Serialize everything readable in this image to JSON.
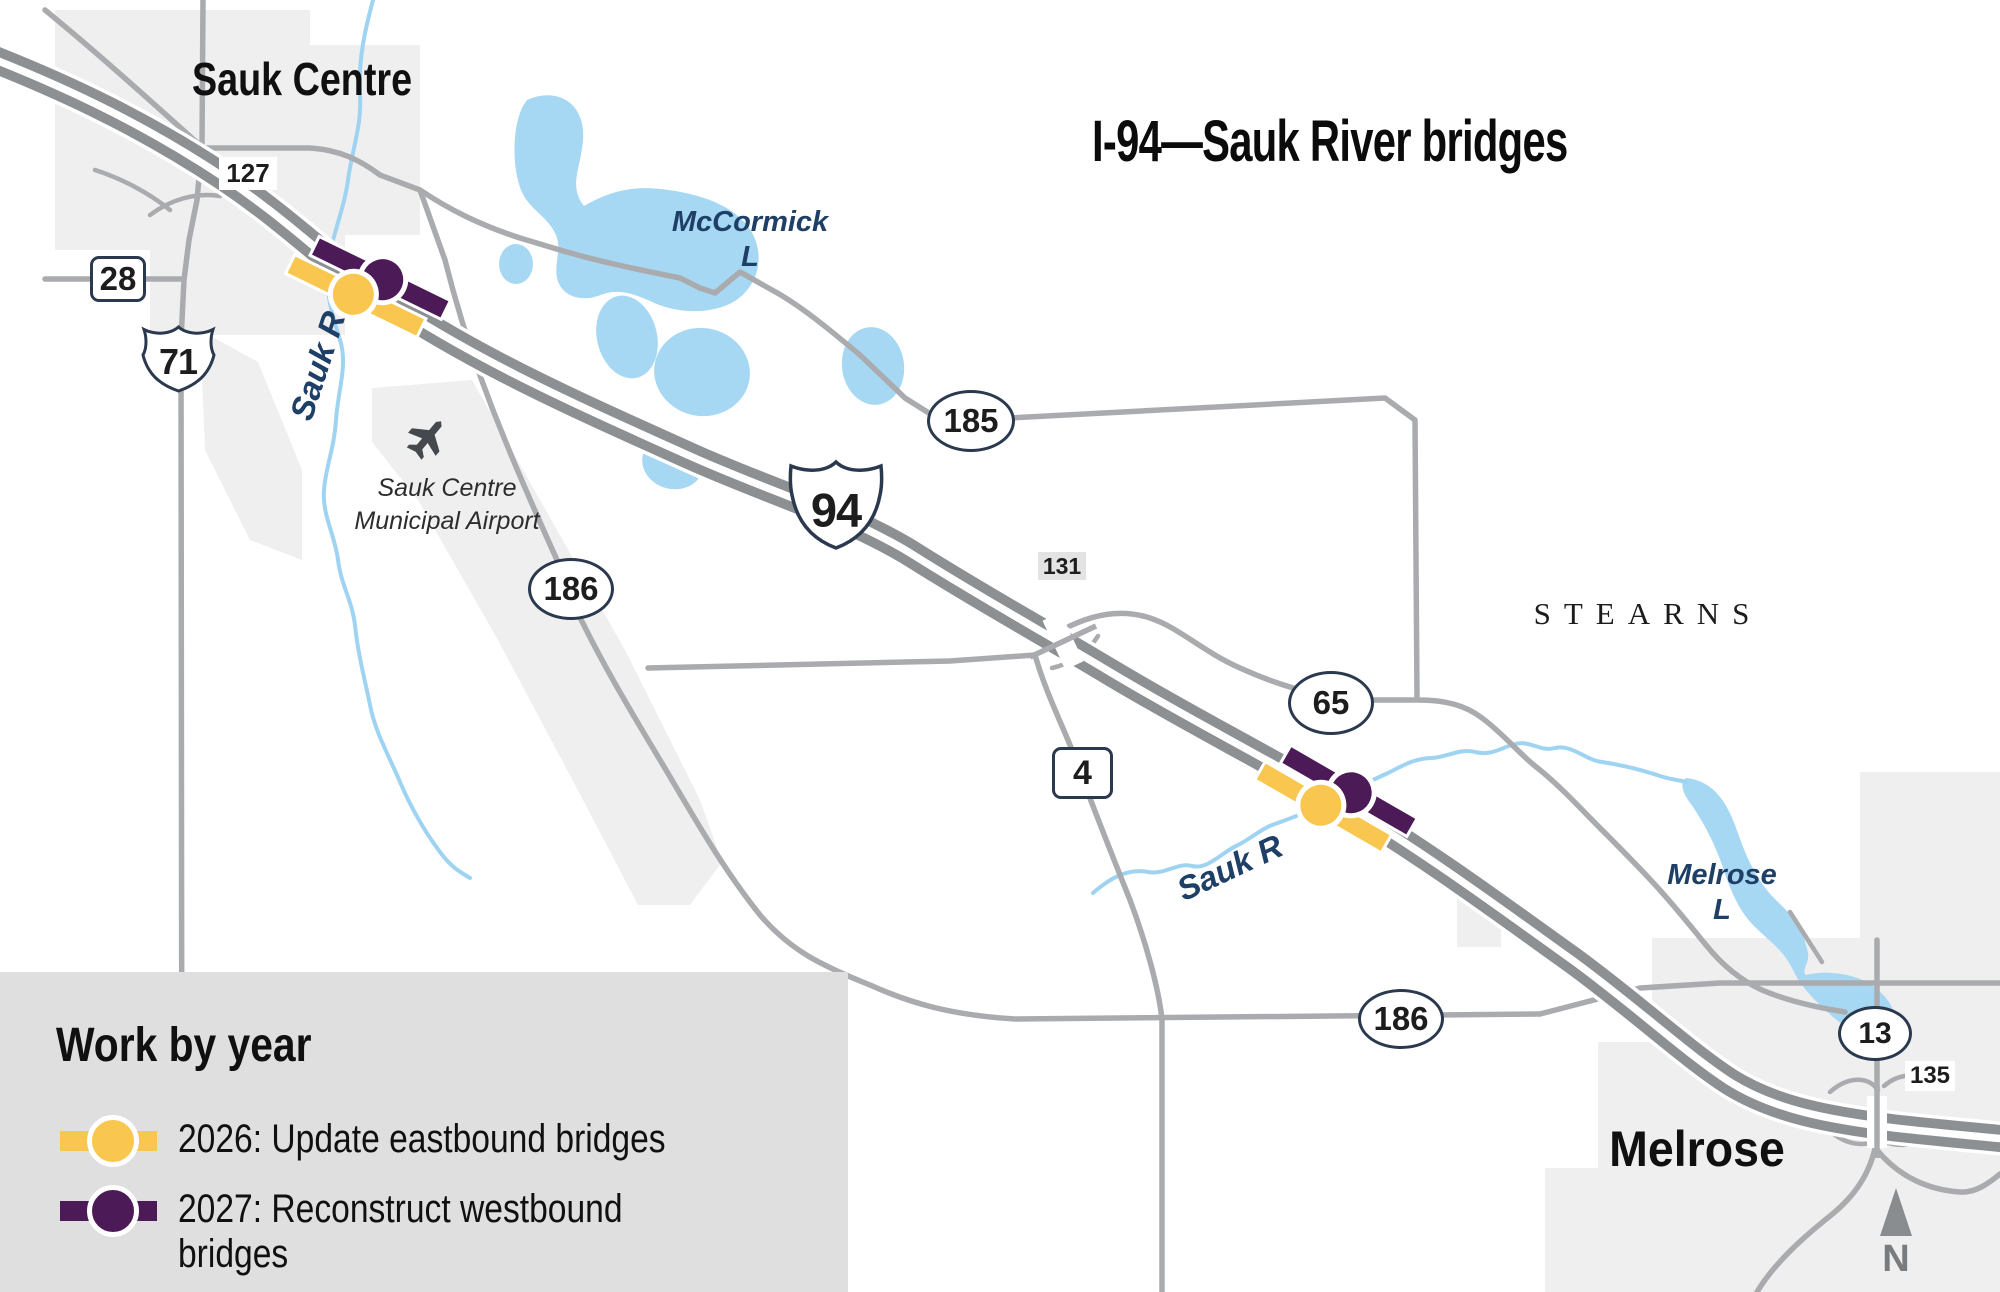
{
  "title": "I-94—Sauk River bridges",
  "region": {
    "county": "STEARNS",
    "city_nw": "Sauk Centre",
    "city_se": "Melrose"
  },
  "water": {
    "mccormick_line1": "McCormick",
    "mccormick_line2": "L",
    "melrose_line1": "Melrose",
    "melrose_line2": "L",
    "river": "Sauk R"
  },
  "airport": {
    "line1": "Sauk Centre",
    "line2": "Municipal Airport"
  },
  "shields": {
    "i94": "94",
    "us71": "71",
    "mn28": "28",
    "mn4": "4",
    "c127": "127",
    "c131": "131",
    "c135": "135",
    "c185": "185",
    "c186": "186",
    "c65": "65",
    "c13": "13"
  },
  "legend": {
    "heading": "Work by year",
    "items": [
      {
        "label": "2026: Update eastbound bridges",
        "color": "#F9C64F"
      },
      {
        "label": "2027: Reconstruct westbound bridges",
        "color": "#4C1A57"
      }
    ]
  },
  "compass": {
    "north": "N"
  },
  "colors": {
    "accent_yellow": "#F9C64F",
    "accent_purple": "#4C1A57",
    "water_blue": "#A7D8F3",
    "river_blue": "#9FD3F2",
    "road_major": "#8D9093",
    "road_minor": "#A9ABAE",
    "city_shade": "#EFEFEF",
    "legend_bg": "#DFDFDF",
    "label_navy": "#1E3F66"
  }
}
